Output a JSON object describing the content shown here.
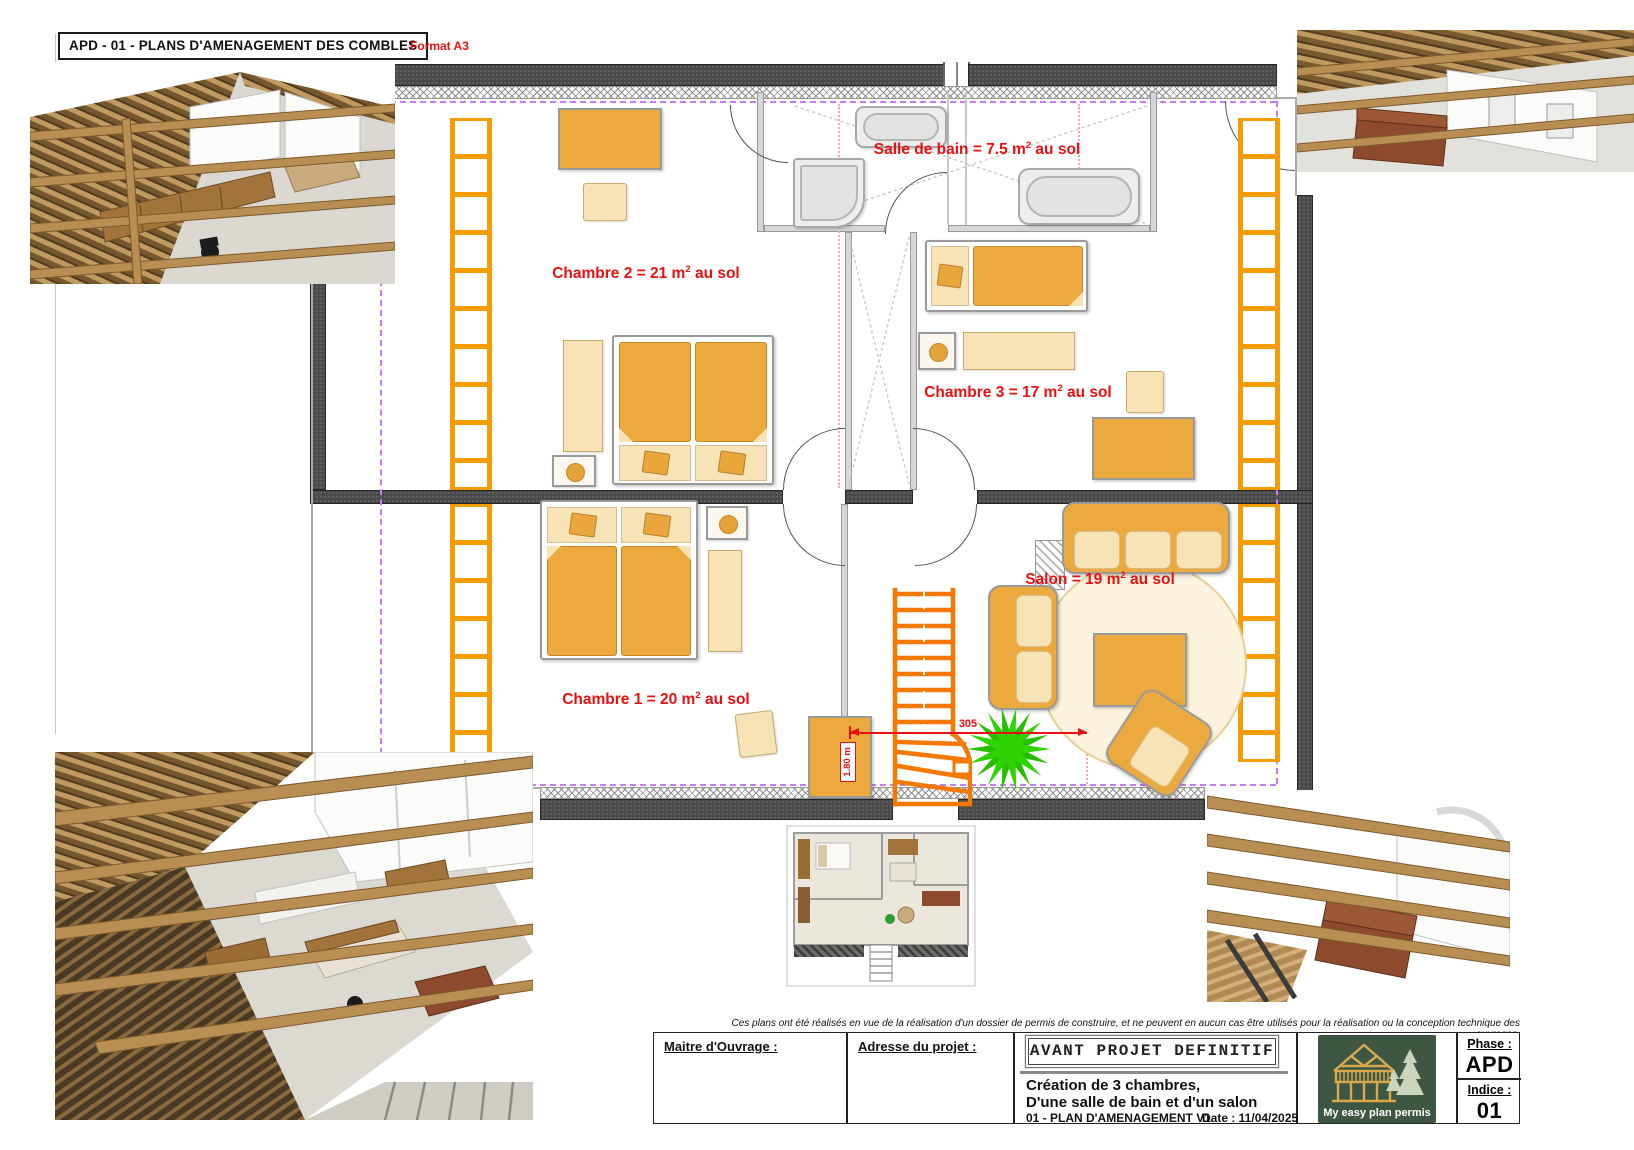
{
  "header": {
    "title": "APD - 01 - PLANS D'AMENAGEMENT DES COMBLES",
    "format": "Format A3"
  },
  "plan": {
    "labels": {
      "bathroom": {
        "pre": "Salle de bain = 7.5 m",
        "sup": "2",
        "post": " au sol"
      },
      "chambre2": {
        "pre": "Chambre 2 = 21 m",
        "sup": "2",
        "post": " au sol"
      },
      "chambre3": {
        "pre": "Chambre 3 = 17 m",
        "sup": "2",
        "post": " au sol"
      },
      "chambre1": {
        "pre": "Chambre 1 = 20 m",
        "sup": "2",
        "post": " au sol"
      },
      "salon": {
        "pre": "Salon = 19 m",
        "sup": "2",
        "post": " au sol"
      }
    },
    "dims": {
      "width": "305",
      "height": "1.80 m"
    }
  },
  "footer": {
    "disclaimer": "Ces plans ont été réalisés en vue de la réalisation d'un dossier de permis de construire, et ne peuvent en aucun cas être utilisés pour la réalisation ou la conception technique des ouvrages.",
    "owner_label": "Maitre d'Ouvrage :",
    "address_label": "Adresse du projet :",
    "phase_title": "AVANT PROJET DEFINITIF",
    "desc_line1": "Création de 3 chambres,",
    "desc_line2": "D'une salle de bain et d'un salon",
    "plan_ref": "01 - PLAN D'AMENAGEMENT V1",
    "date_label": "Date : 11/04/2025",
    "phase_label": "Phase :",
    "phase_value": "APD",
    "indice_label": "Indice :",
    "indice_value": "01",
    "logo_text": "My easy plan permis"
  },
  "colors": {
    "label_red": "#e81010",
    "furniture_orange": "#eca93d",
    "furniture_cream": "#f7e3b6",
    "ladder_orange": "#f59d00",
    "stair_orange": "#f57900",
    "boundary_purple": "#c77df0",
    "plant_green": "#2fd400",
    "logo_green": "#3e5743",
    "logo_gold": "#d9a94c"
  }
}
